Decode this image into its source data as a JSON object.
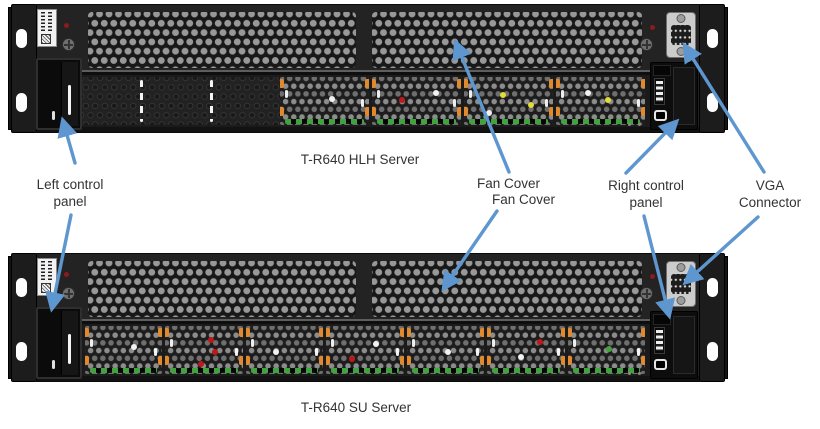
{
  "servers": [
    {
      "name": "T-R640 HLH Server",
      "variant": "hlh"
    },
    {
      "name": "T-R640 SU Server",
      "variant": "su"
    }
  ],
  "callouts": {
    "left_control_panel": {
      "line1": "Left control",
      "line2": "panel"
    },
    "fan_cover_hlh": "Fan Cover",
    "fan_cover_su": "Fan Cover",
    "right_control_panel": {
      "line1": "Right control",
      "line2": "panel"
    },
    "vga_connector": {
      "line1": "VGA",
      "line2": "Connector"
    }
  },
  "colors": {
    "arrow": "#5E96CF",
    "text": "#333333",
    "chassis": "#232323",
    "grille_dot": "#989898",
    "fan_dot": "#8C8C8C",
    "clip_orange": "#E08A2D",
    "pcb_green": "#41A33E",
    "led_yellow": "#E2DC3A",
    "led_red": "#C01818",
    "led_white": "#F2F2F2",
    "vga_body": "#CCCCCC"
  }
}
